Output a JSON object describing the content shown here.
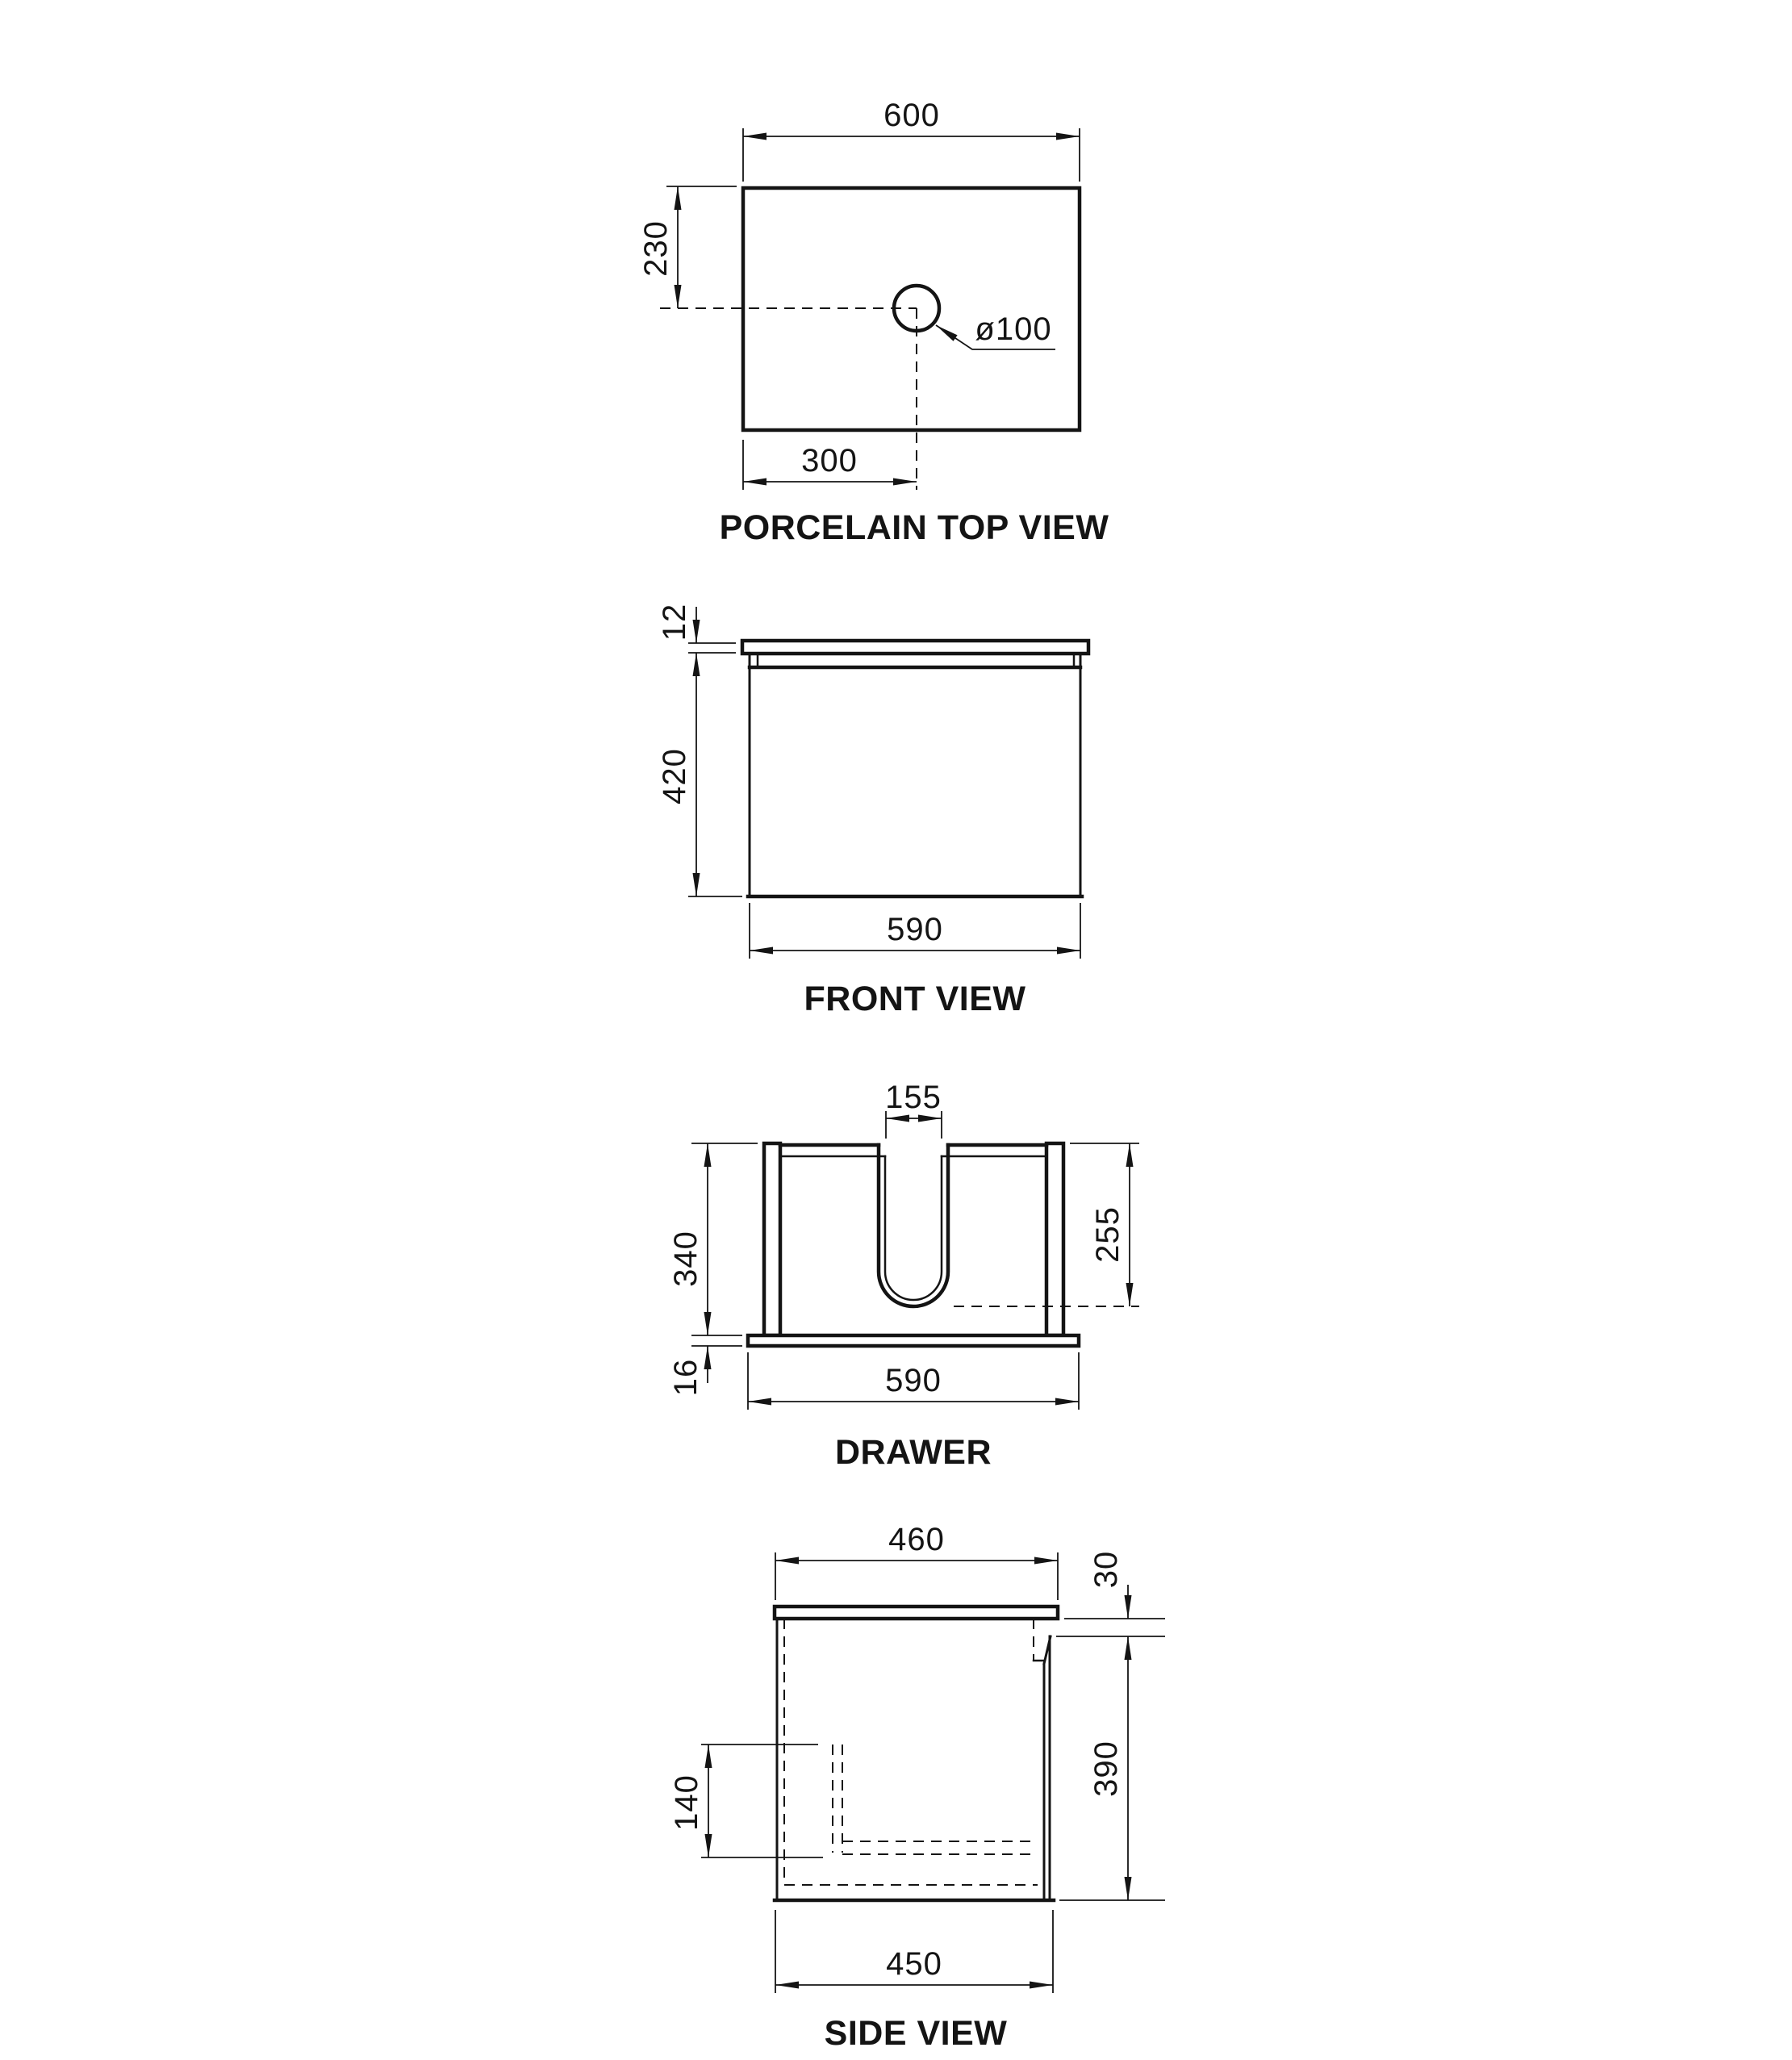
{
  "page": {
    "background": "#ffffff",
    "line_color": "#141414"
  },
  "views": {
    "porcelain_top": {
      "title": "PORCELAIN TOP VIEW",
      "dims": {
        "overall_width": "600",
        "hole_center_from_back": "230",
        "hole_diameter": "ø100",
        "hole_center_from_left": "300"
      }
    },
    "front": {
      "title": "FRONT VIEW",
      "dims": {
        "top_thickness": "12",
        "cabinet_height": "420",
        "cabinet_width": "590"
      }
    },
    "drawer": {
      "title": "DRAWER",
      "dims": {
        "cutout_width": "155",
        "side_height": "340",
        "cutout_depth": "255",
        "base_thickness": "16",
        "base_width": "590"
      }
    },
    "side": {
      "title": "SIDE VIEW",
      "dims": {
        "top_depth": "460",
        "top_to_handle": "30",
        "body_height": "390",
        "drawer_base_height": "140",
        "body_depth": "450"
      }
    }
  }
}
